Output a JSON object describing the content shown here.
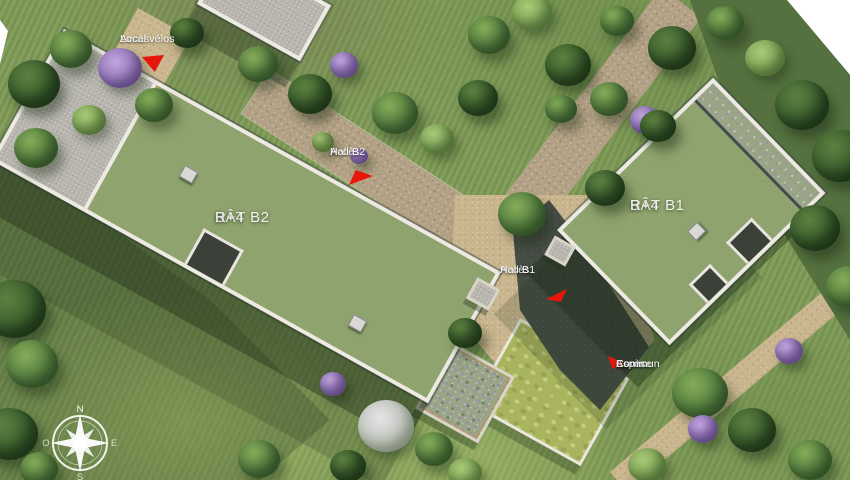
{
  "site_plan": {
    "buildings": [
      {
        "id": "b2",
        "name": "BÂT B2",
        "floors": "R+4"
      },
      {
        "id": "b1",
        "name": "BÂT B1",
        "floors": "R+4"
      }
    ],
    "access_points": [
      {
        "id": "local-velos",
        "line1": "Accès",
        "line2": "Local vélos"
      },
      {
        "id": "hall-b2",
        "line1": "Accès",
        "line2": "Hall B2"
      },
      {
        "id": "hall-b1",
        "line1": "Accès",
        "line2": "Hall B1"
      },
      {
        "id": "espace-commun",
        "line1": "Accès",
        "line2": "Espace",
        "line3": "Commun"
      }
    ],
    "compass": {
      "north": "N",
      "east": "E",
      "south": "S",
      "west": "O"
    },
    "colors": {
      "access_marker_red": "#e8150b",
      "parapet_white": "#eceae2",
      "green_roof": "#8ea36d",
      "gravel_roof": "#b7b5ad",
      "path_tan": "#b2a184",
      "grass_green": "#7d9a55",
      "entry_court_dark": "#454c44"
    }
  }
}
